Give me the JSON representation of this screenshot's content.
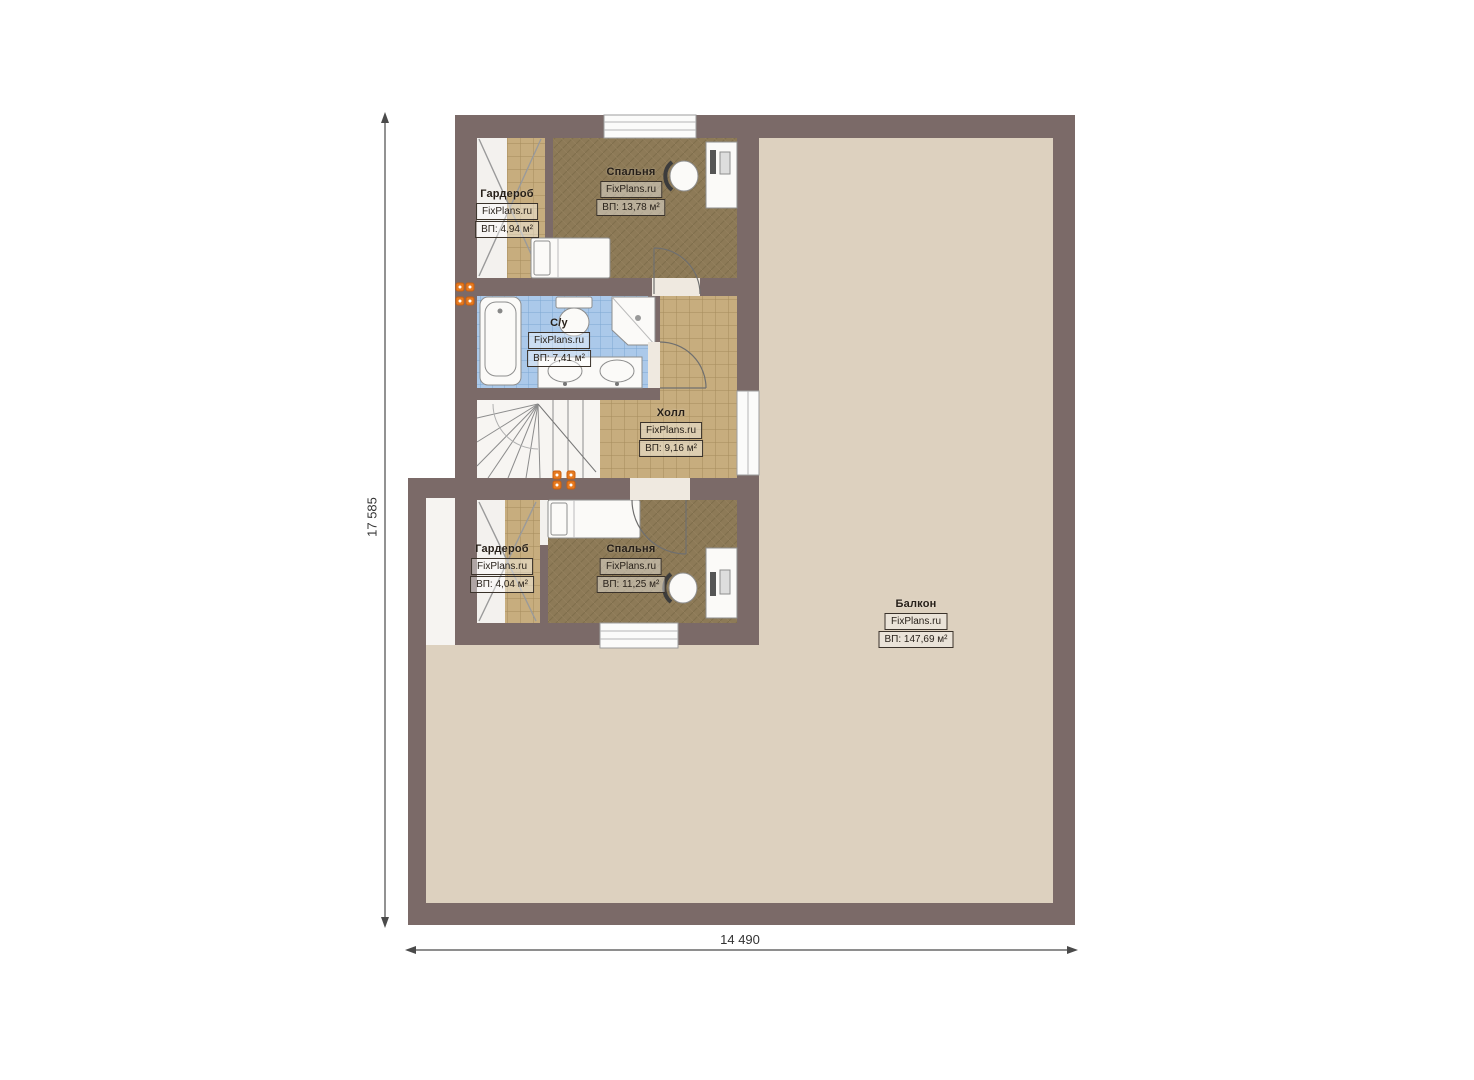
{
  "plan": {
    "dim_vertical": "17 585",
    "dim_horizontal": "14 490"
  },
  "rooms": {
    "wardrobe1": {
      "name": "Гардероб",
      "brand": "FixPlans.ru",
      "area": "ВП: 4,94 м²"
    },
    "bedroom1": {
      "name": "Спальня",
      "brand": "FixPlans.ru",
      "area": "ВП: 13,78 м²"
    },
    "bathroom": {
      "name": "С/у",
      "brand": "FixPlans.ru",
      "area": "ВП: 7,41 м²"
    },
    "hall": {
      "name": "Холл",
      "brand": "FixPlans.ru",
      "area": "ВП: 9,16 м²"
    },
    "wardrobe2": {
      "name": "Гардероб",
      "brand": "FixPlans.ru",
      "area": "ВП: 4,04 м²"
    },
    "bedroom2": {
      "name": "Спальня",
      "brand": "FixPlans.ru",
      "area": "ВП: 11,25 м²"
    },
    "balcony": {
      "name": "Балкон",
      "brand": "FixPlans.ru",
      "area": "ВП: 147,69 м²"
    }
  },
  "colors": {
    "wall": "#7b6a68",
    "balcony_floor": "#ddd1bf",
    "carpet": "#8d7a57",
    "tile": "#c7ad7e",
    "bath_tile": "#abc9ea",
    "radiator": "#e87b20"
  }
}
